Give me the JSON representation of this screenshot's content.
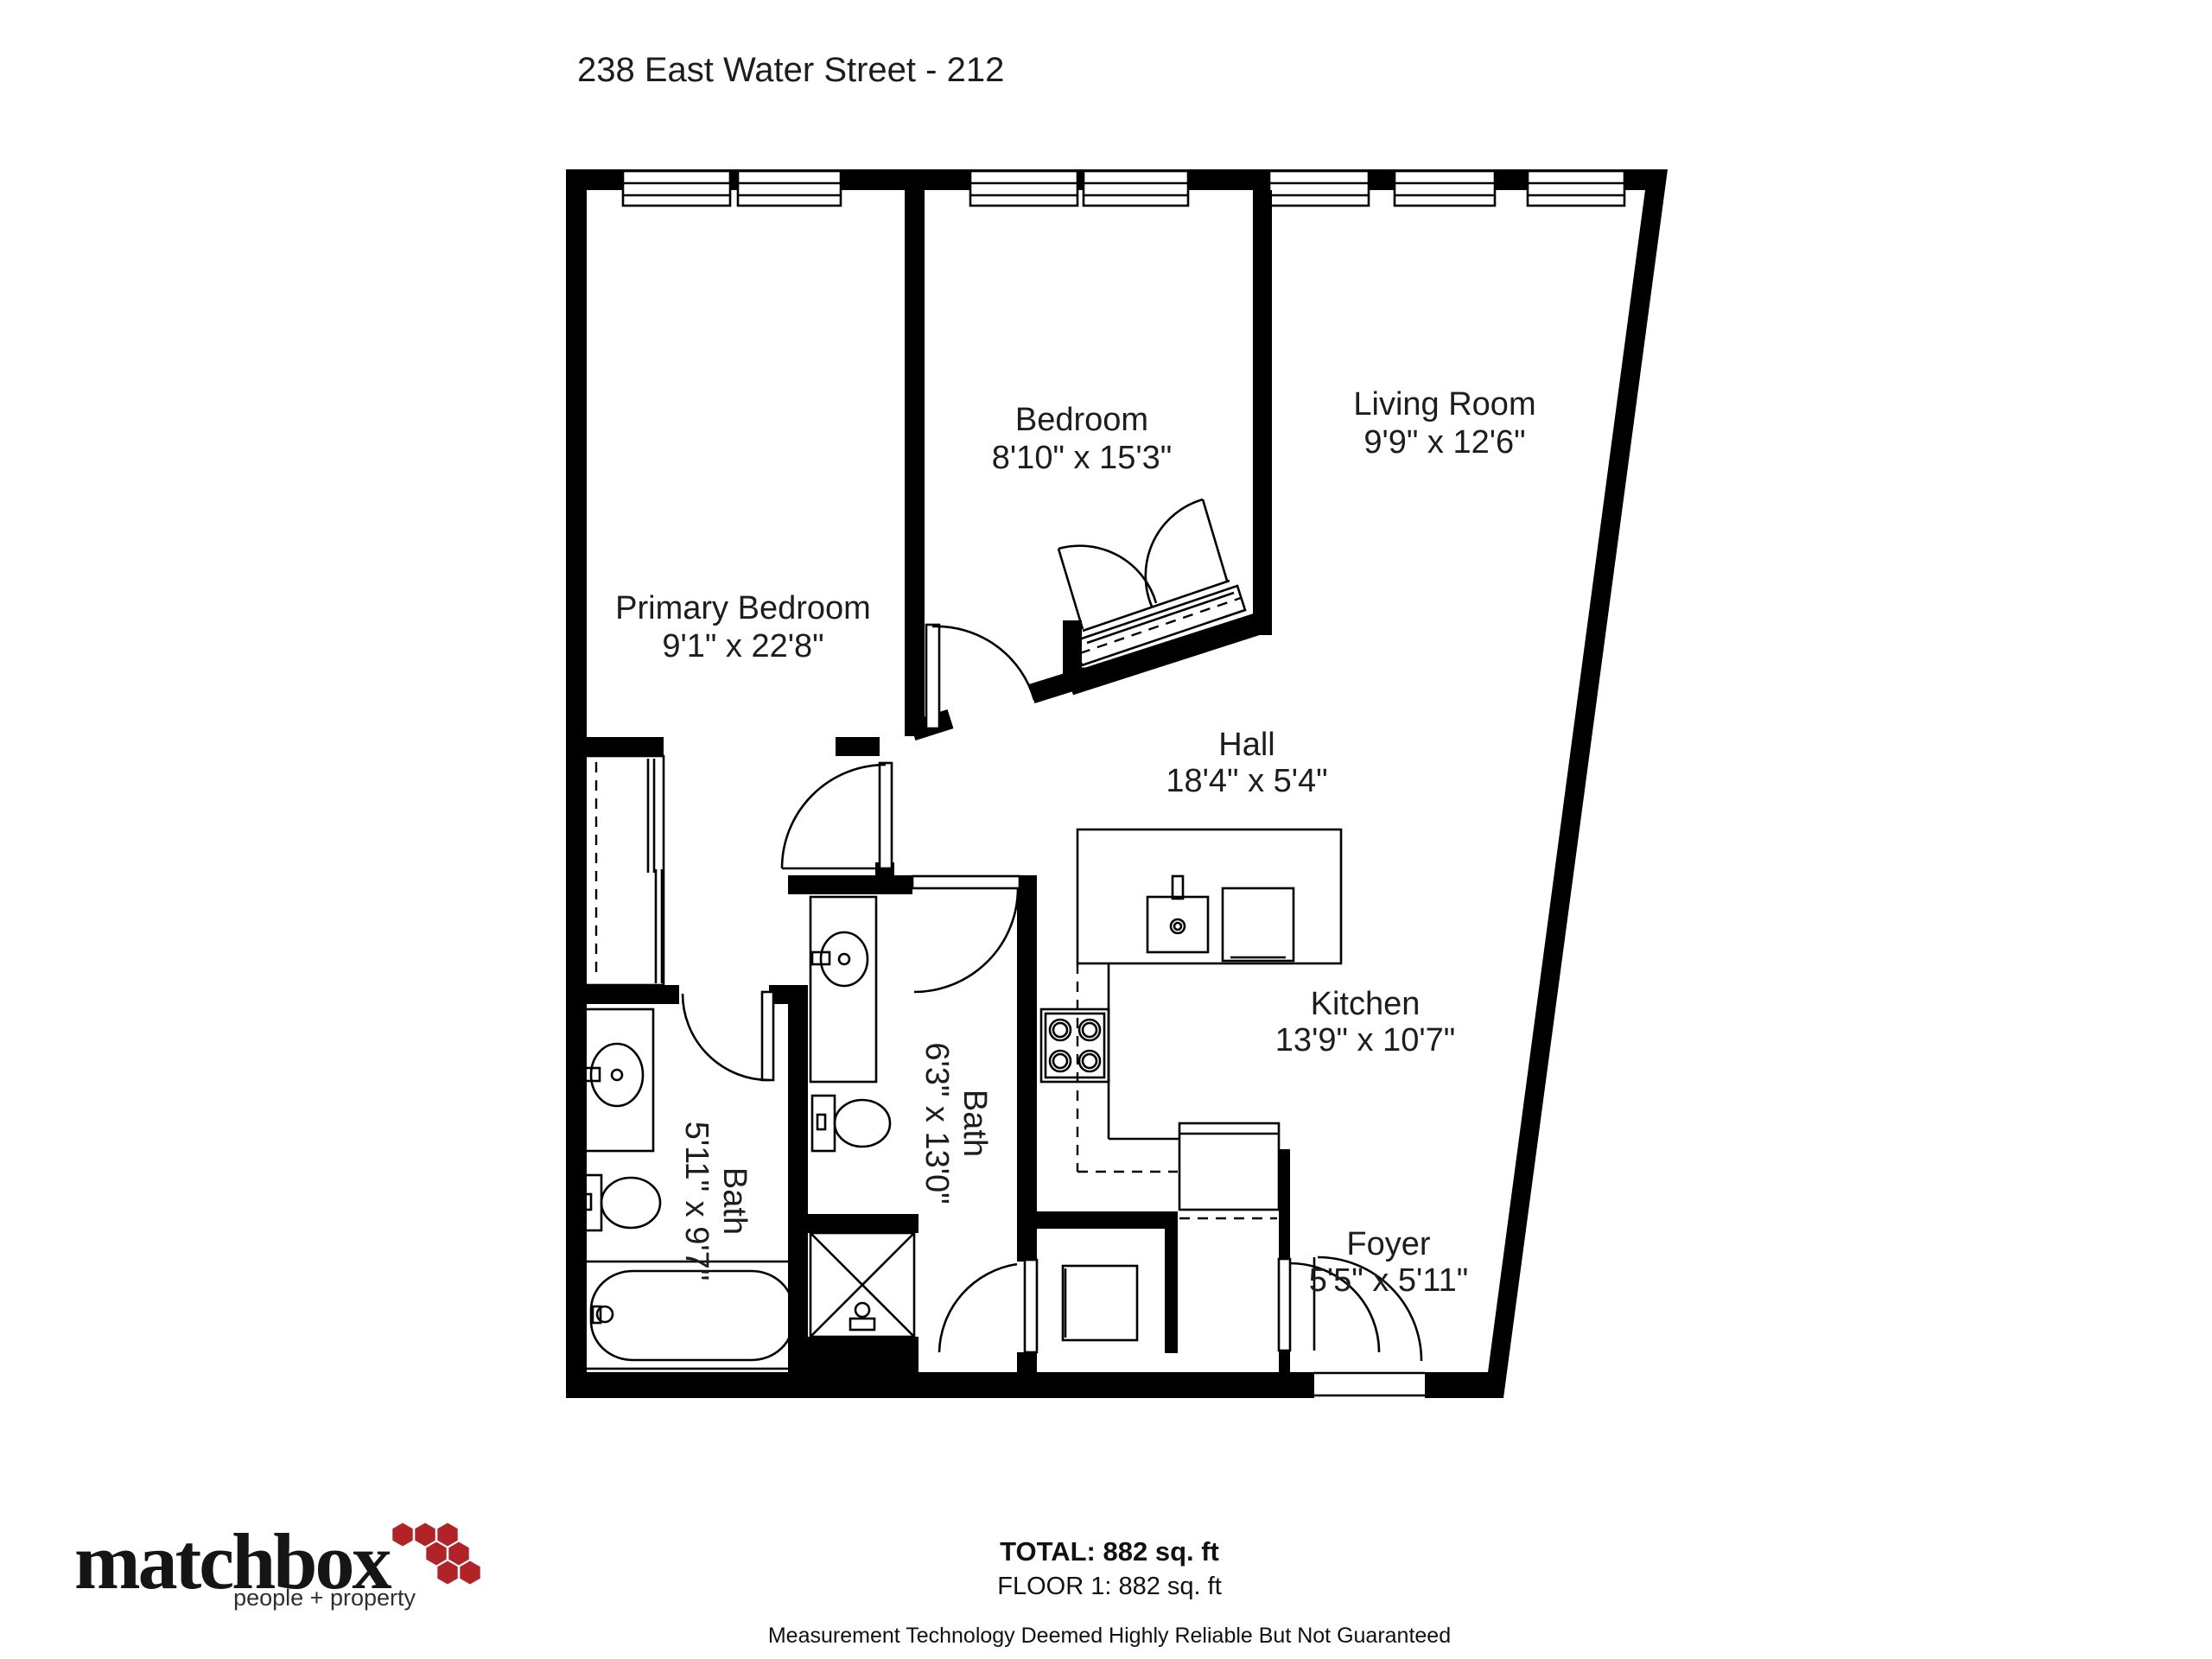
{
  "page": {
    "title": "238 East Water Street - 212"
  },
  "rooms": {
    "primary_bedroom": {
      "name": "Primary Bedroom",
      "dims": "9'1\" x 22'8\""
    },
    "bedroom": {
      "name": "Bedroom",
      "dims": "8'10\" x 15'3\""
    },
    "living_room": {
      "name": "Living Room",
      "dims": "9'9\" x 12'6\""
    },
    "hall": {
      "name": "Hall",
      "dims": "18'4\" x 5'4\""
    },
    "kitchen": {
      "name": "Kitchen",
      "dims": "13'9\" x 10'7\""
    },
    "bath_primary": {
      "name": "Bath",
      "dims": "5'11\" x 9'7\""
    },
    "bath_hall": {
      "name": "Bath",
      "dims": "6'3\" x 13'0\""
    },
    "foyer": {
      "name": "Foyer",
      "dims": "5'5\" x 5'11\""
    }
  },
  "footer": {
    "total": "TOTAL: 882 sq. ft",
    "floor": "FLOOR 1: 882 sq. ft",
    "disclaimer": "Measurement Technology Deemed Highly Reliable But Not Guaranteed"
  },
  "logo": {
    "brand": "matchbox",
    "tagline": "people + property",
    "accent_color": "#b22328"
  },
  "colors": {
    "walls": "#000000",
    "text": "#1d1d1d"
  }
}
